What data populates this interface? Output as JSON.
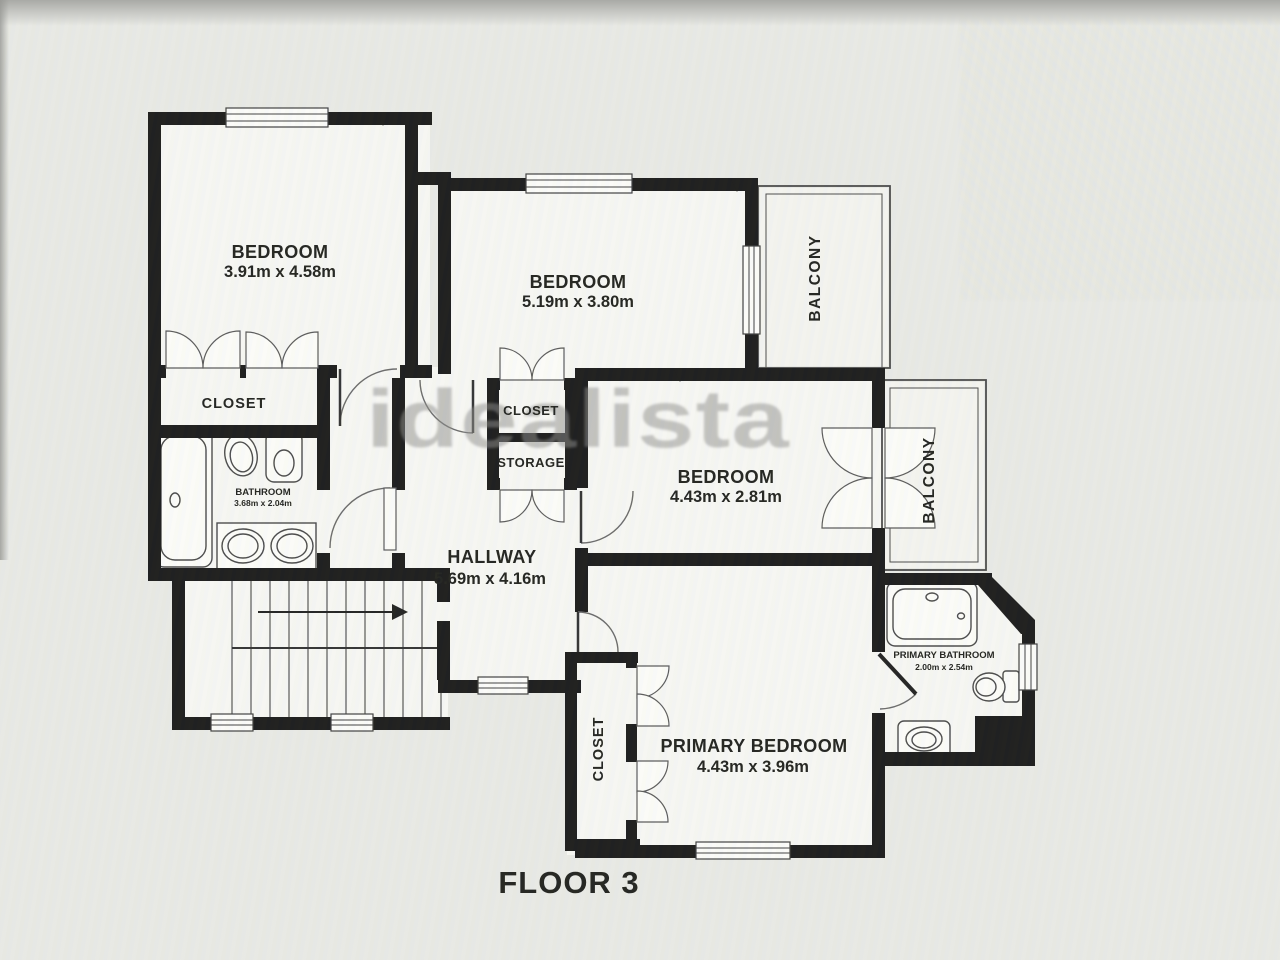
{
  "floor_plan": {
    "title": "FLOOR 3",
    "watermark": "idealista",
    "colors": {
      "wall": "#1c1c1c",
      "floor": "#f6f6f3",
      "background": "#e8e9e5",
      "watermark": "#8d8d8b"
    },
    "rooms": {
      "bedroom1": {
        "label": "BEDROOM",
        "dims": "3.91m x 4.58m"
      },
      "bedroom2": {
        "label": "BEDROOM",
        "dims": "5.19m x 3.80m"
      },
      "bedroom3": {
        "label": "BEDROOM",
        "dims": "4.43m x 2.81m"
      },
      "primary_bedroom": {
        "label": "PRIMARY BEDROOM",
        "dims": "4.43m x 3.96m"
      },
      "hallway": {
        "label": "HALLWAY",
        "dims": "5.69m x 4.16m"
      },
      "bathroom": {
        "label": "BATHROOM",
        "dims": "3.68m x 2.04m"
      },
      "primary_bathroom": {
        "label": "PRIMARY BATHROOM",
        "dims": "2.00m x 2.54m"
      },
      "closet_bedroom1": {
        "label": "CLOSET"
      },
      "closet_hall": {
        "label": "CLOSET"
      },
      "storage": {
        "label": "STORAGE"
      },
      "closet_primary": {
        "label": "CLOSET"
      },
      "balcony_top": {
        "label": "BALCONY"
      },
      "balcony_mid": {
        "label": "BALCONY"
      }
    }
  }
}
